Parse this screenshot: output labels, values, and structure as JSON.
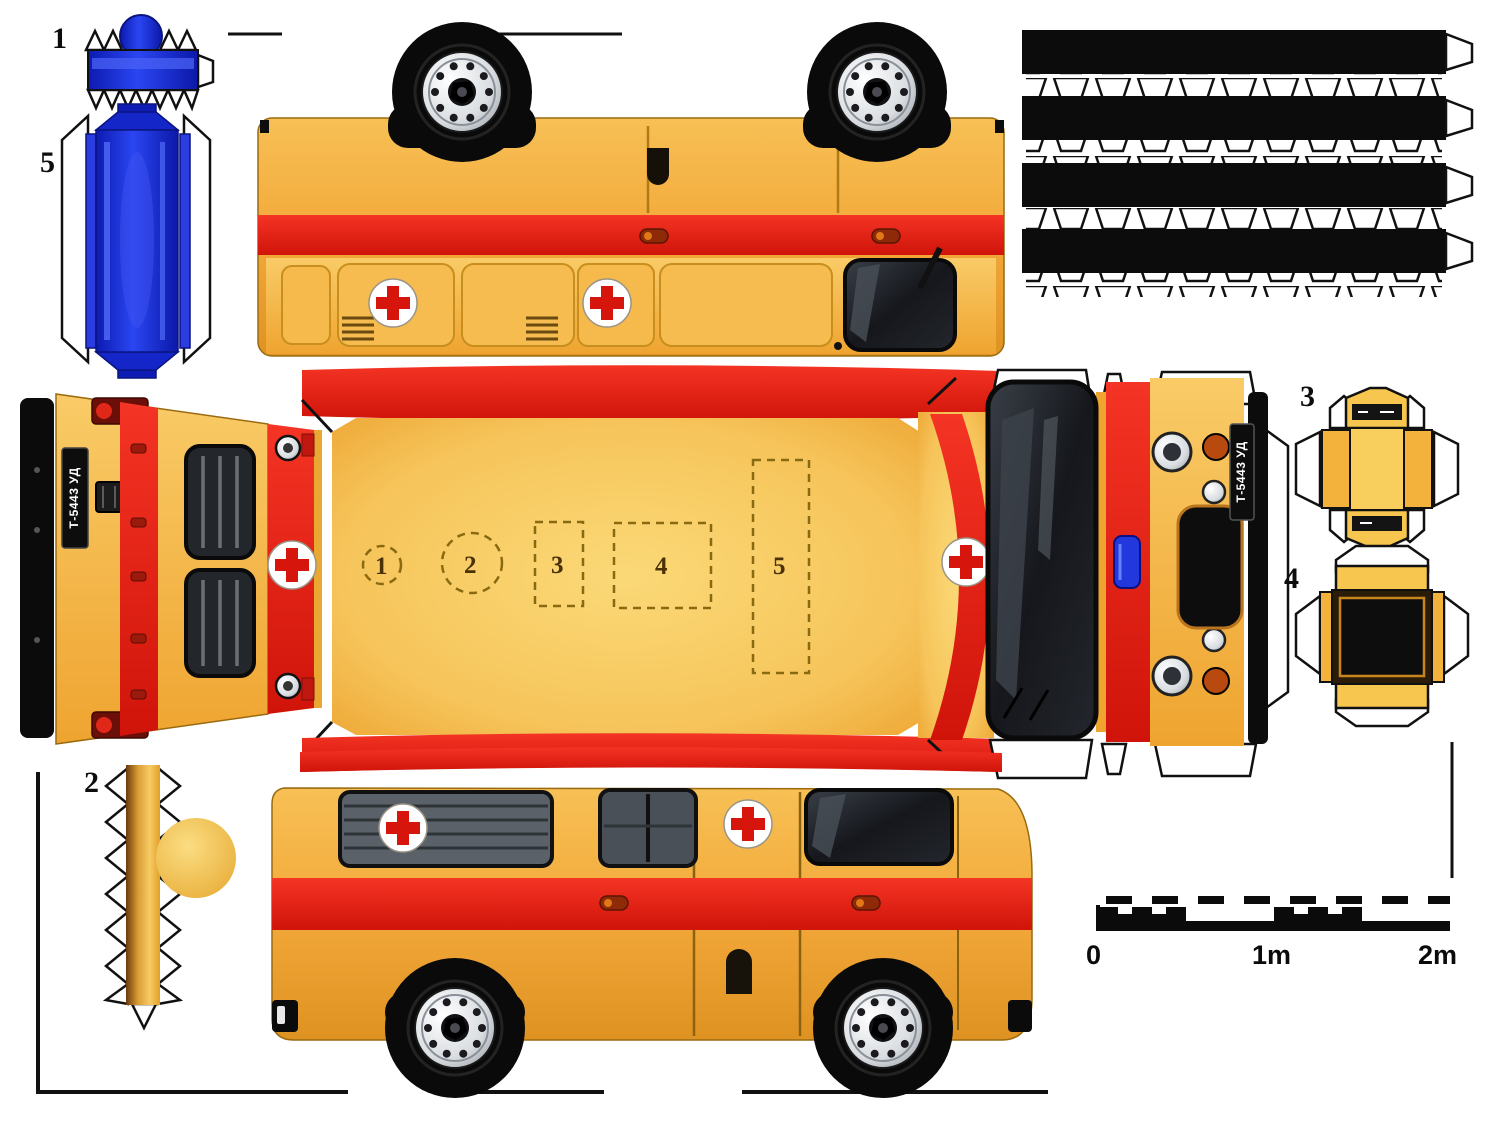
{
  "sheet": {
    "description": "ambulance van papercraft cut-out sheet"
  },
  "parts": {
    "p1": {
      "label": "1",
      "name": "blue beacon strip"
    },
    "p2": {
      "label": "2",
      "name": "pole with ball"
    },
    "p3": {
      "label": "3",
      "name": "small fold box"
    },
    "p4": {
      "label": "4",
      "name": "large fold box"
    },
    "p5": {
      "label": "5",
      "name": "blue box"
    }
  },
  "roof_marks": {
    "m1": "1",
    "m2": "2",
    "m3": "3",
    "m4": "4",
    "m5": "5"
  },
  "license_plates": {
    "rear": "Т-5443 УД",
    "front": "Т-5443 УД"
  },
  "scale_bar": {
    "start": "0",
    "middle": "1m",
    "end": "2m"
  },
  "colors": {
    "body_yellow": "#F3A93A",
    "stripe_red": "#E2190E",
    "beacon_blue": "#2237DC",
    "cross_red": "#D6150C",
    "tire_black": "#0B0B0B"
  }
}
